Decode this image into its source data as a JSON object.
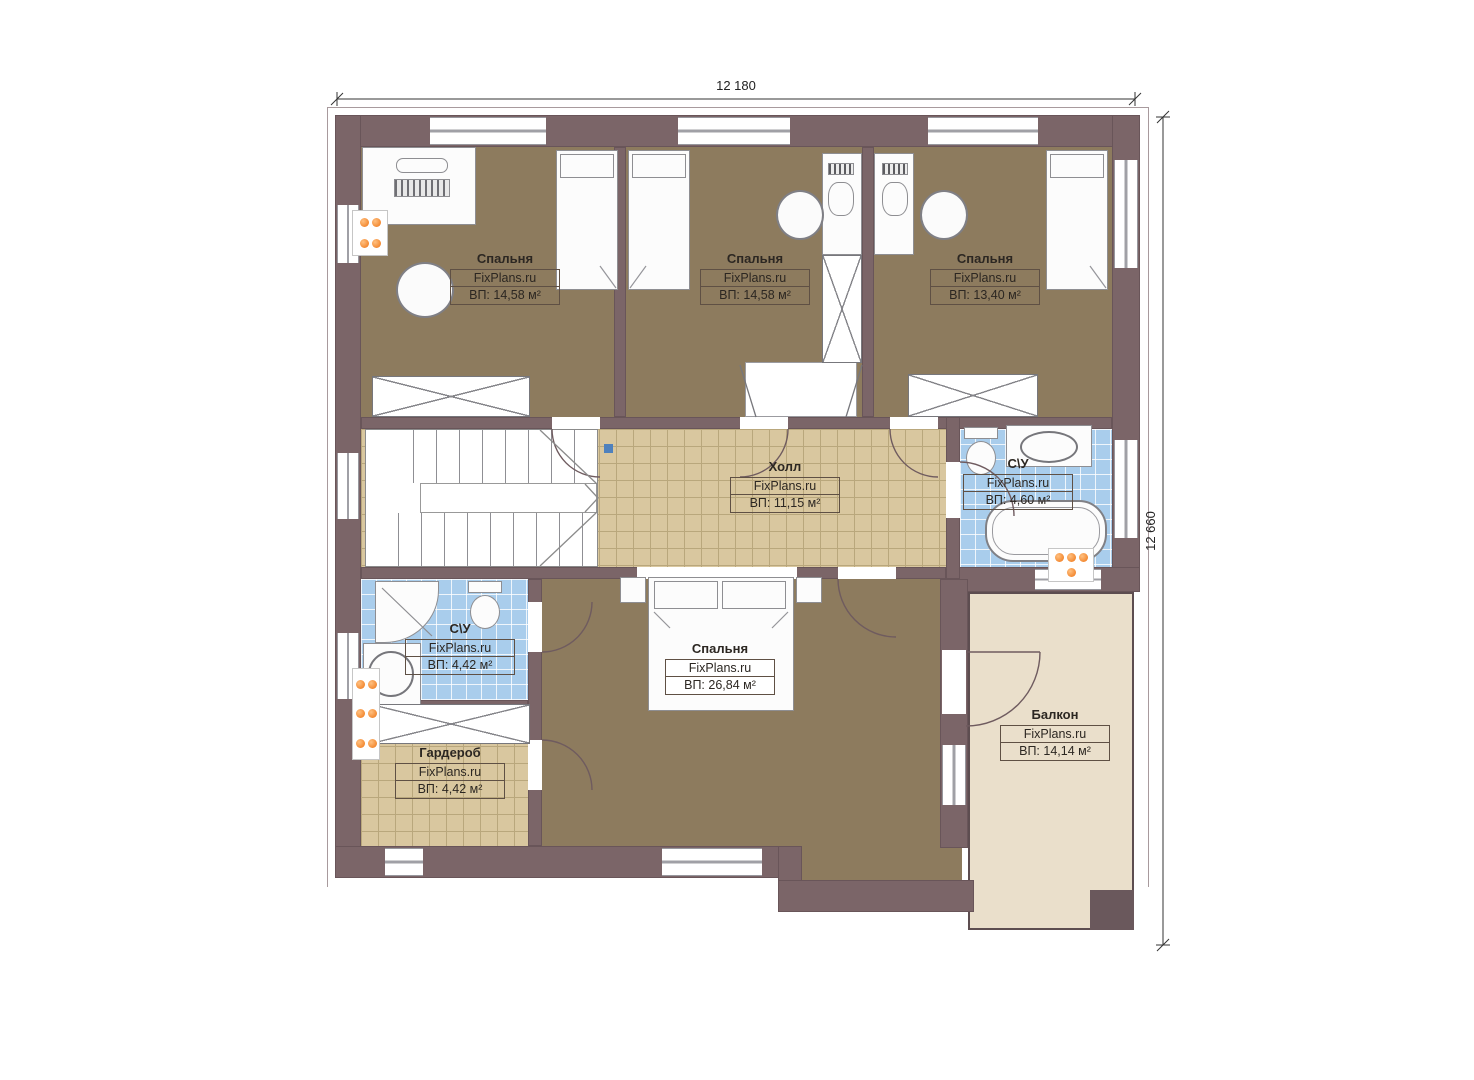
{
  "brand": "FixPlans.ru",
  "dimensions": {
    "width_top": "12 180",
    "height_right": "12 660"
  },
  "rooms": [
    {
      "name": "Спальня",
      "brand": "FixPlans.ru",
      "area": "ВП: 14,58 м²"
    },
    {
      "name": "Спальня",
      "brand": "FixPlans.ru",
      "area": "ВП: 14,58 м²"
    },
    {
      "name": "Спальня",
      "brand": "FixPlans.ru",
      "area": "ВП: 13,40 м²"
    },
    {
      "name": "Холл",
      "brand": "FixPlans.ru",
      "area": "ВП: 11,15 м²"
    },
    {
      "name": "С\\У",
      "brand": "FixPlans.ru",
      "area": "ВП: 4,60 м²"
    },
    {
      "name": "С\\У",
      "brand": "FixPlans.ru",
      "area": "ВП: 4,42 м²"
    },
    {
      "name": "Гардероб",
      "brand": "FixPlans.ru",
      "area": "ВП: 4,42 м²"
    },
    {
      "name": "Спальня",
      "brand": "FixPlans.ru",
      "area": "ВП: 26,84 м²"
    },
    {
      "name": "Балкон",
      "brand": "FixPlans.ru",
      "area": "ВП: 14,14 м²"
    }
  ],
  "palette": {
    "wall": "#7b6568",
    "bedroom_floor": "#8d7b5e",
    "tile_floor": "#d9c79f",
    "bath_tile": "#a9cdec",
    "balcony_floor": "#eadfcb",
    "radiator": "#ee7414",
    "stair_marker": "#4f81bd"
  }
}
